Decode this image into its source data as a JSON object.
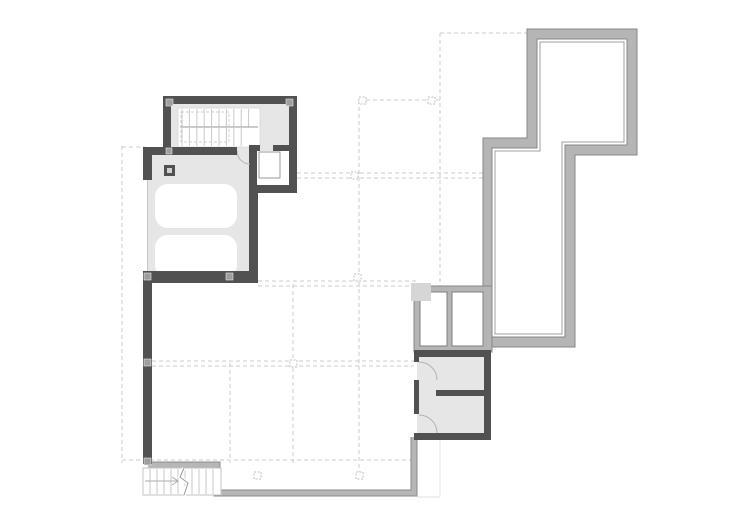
{
  "document": {
    "type": "architectural-floor-plan",
    "visible_text": "",
    "notes": "roof / upper-level plan drawing, no text labels visible"
  },
  "palette": {
    "wall": "#515151",
    "floor": "#e6e6e6",
    "band": "#b5b5b5",
    "bandedge": "#878787",
    "accent": "#9f9f9f",
    "dashed": "#cbcbcb",
    "marker": "#9e9e9e",
    "tread": "#c9c9c9",
    "arc": "#b3b3b3",
    "ghost": "#e2e2e2"
  },
  "plan": {
    "rooms": [
      {
        "id": "stair-room",
        "kind": "interior staircase enclosure"
      },
      {
        "id": "elevator-shaft",
        "kind": "elevator"
      },
      {
        "id": "garage",
        "kind": "garage with parking spaces"
      },
      {
        "id": "skylight-block",
        "kind": "two glazed roof openings"
      },
      {
        "id": "service-rooms",
        "kind": "two small rooms with doors"
      },
      {
        "id": "upper-volume-outline",
        "kind": "parapet / upper wall band"
      },
      {
        "id": "terrace-parapet",
        "kind": "lower roof edge band"
      },
      {
        "id": "exterior-stair",
        "kind": "open stair at lower edge"
      }
    ],
    "counts": {
      "cars": 2,
      "skylights": 2,
      "door_arcs": 3,
      "grid_markers": 7
    }
  }
}
